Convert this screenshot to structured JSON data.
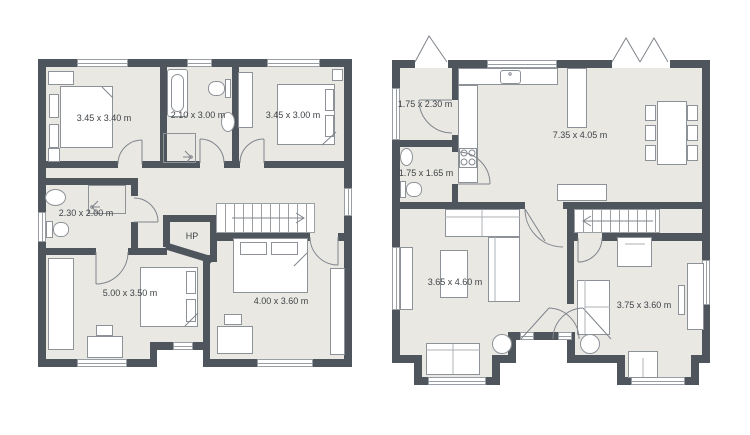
{
  "colors": {
    "wall": "#4f555c",
    "floor": "#e9e8e3",
    "furniture_line": "#8d9298",
    "text": "#3f4347",
    "background": "#ffffff"
  },
  "left_plan": {
    "rooms": [
      {
        "id": "bedroom-1",
        "label": "3.45 x 3.40 m"
      },
      {
        "id": "bathroom-1",
        "label": "2.10 x 3.00 m"
      },
      {
        "id": "bedroom-2",
        "label": "3.45 x 3.00 m"
      },
      {
        "id": "bathroom-2",
        "label": "2.30 x 2.00 m"
      },
      {
        "id": "hp-closet",
        "label": "HP"
      },
      {
        "id": "bedroom-3",
        "label": "5.00 x 3.50 m"
      },
      {
        "id": "bedroom-4",
        "label": "4.00 x 3.60 m"
      }
    ]
  },
  "right_plan": {
    "rooms": [
      {
        "id": "hallway",
        "label": "1.75 x 2.30 m"
      },
      {
        "id": "wc",
        "label": "1.75 x 1.65 m"
      },
      {
        "id": "kitchen-dining",
        "label": "7.35 x 4.05 m"
      },
      {
        "id": "living-room",
        "label": "3.65 x 4.60 m"
      },
      {
        "id": "study",
        "label": "3.75 x 3.60 m"
      }
    ]
  }
}
